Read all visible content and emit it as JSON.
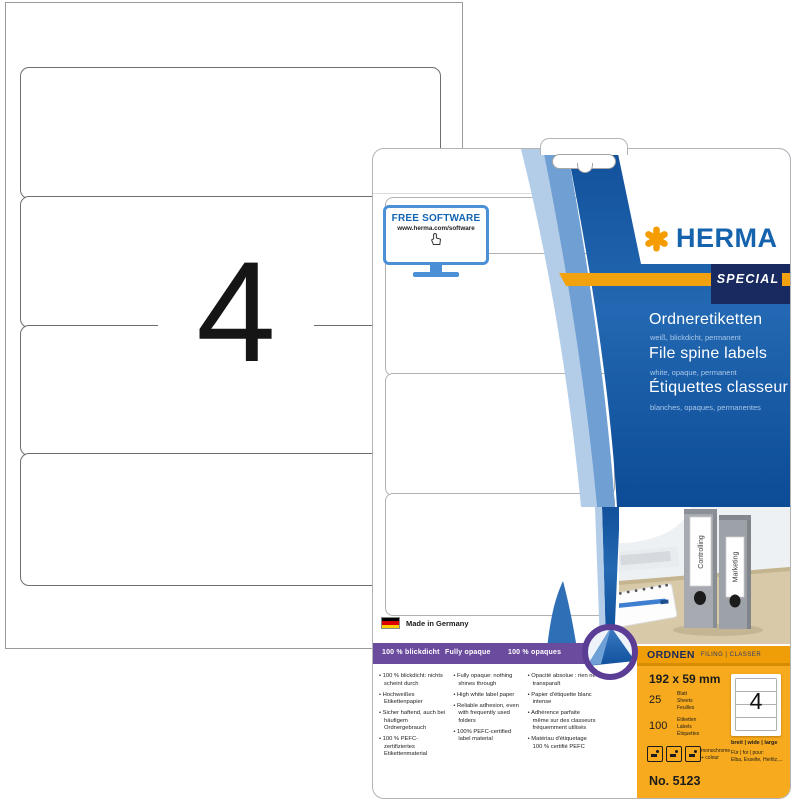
{
  "colors": {
    "brand_blue": "#1563ad",
    "accent_orange": "#f5a11a",
    "navy_band": "#182a60",
    "panel_blue_top": "#2e6fb6",
    "panel_blue_bottom": "#0c4b96",
    "purple": "#6b4b9e",
    "spec_orange": "#f7aa1e"
  },
  "sheet_preview": {
    "count": "4"
  },
  "package": {
    "free_software": {
      "title": "FREE SOFTWARE",
      "url": "www.herma.com/software"
    },
    "brand": "HERMA",
    "badge": "SPECIAL",
    "titles": [
      {
        "title": "Ordneretiketten",
        "subtitle": "weiß, blickdicht, permanent"
      },
      {
        "title": "File spine labels",
        "subtitle": "white, opaque, permanent"
      },
      {
        "title": "Étiquettes classeur",
        "subtitle": "blanches, opaques, permanentes"
      }
    ],
    "made_in": "Made in Germany",
    "feature_headers": [
      "100 % blickdicht",
      "Fully opaque",
      "100 % opaques"
    ],
    "features_de": [
      "100 % blickdicht: nichts scheint durch",
      "Hochweißes Etikettenpapier",
      "Sicher haftend, auch bei häufigem Ordnergebrauch",
      "100 % PEFC-zertifiziertes Etikettenmaterial"
    ],
    "features_en": [
      "Fully opaque: nothing shines through",
      "High white label paper",
      "Reliable adhesion, even with frequently used folders",
      "100% PEFC-certified label material"
    ],
    "features_fr": [
      "Opacité absolue : rien ne transparaît",
      "Papier d'étiquette blanc intense",
      "Adhérence parfaite même sur des classeurs fréquemment utilisés",
      "Matériau d'étiquetage 100 % certifié PEFC"
    ],
    "photo": {
      "binder_labels": [
        "Controlling",
        "Marketing"
      ]
    },
    "category": {
      "title": "ORDNEN",
      "subtitle": "FILING | CLASSER"
    },
    "specs": {
      "size": "192 x 59 mm",
      "sheets_value": "25",
      "sheets_words": [
        "Blatt",
        "Sheets",
        "Feuilles"
      ],
      "labels_value": "100",
      "labels_words": [
        "Etiketten",
        "Labels",
        "Étiquettes"
      ],
      "print_note": "monochrome + colour",
      "mini_count": "4",
      "width_note": "breit | wide | large",
      "for_note": "Für | for | pour:",
      "brands_note": "Elba, Esselte, Herlitz,...",
      "article_no": "No. 5123"
    }
  }
}
